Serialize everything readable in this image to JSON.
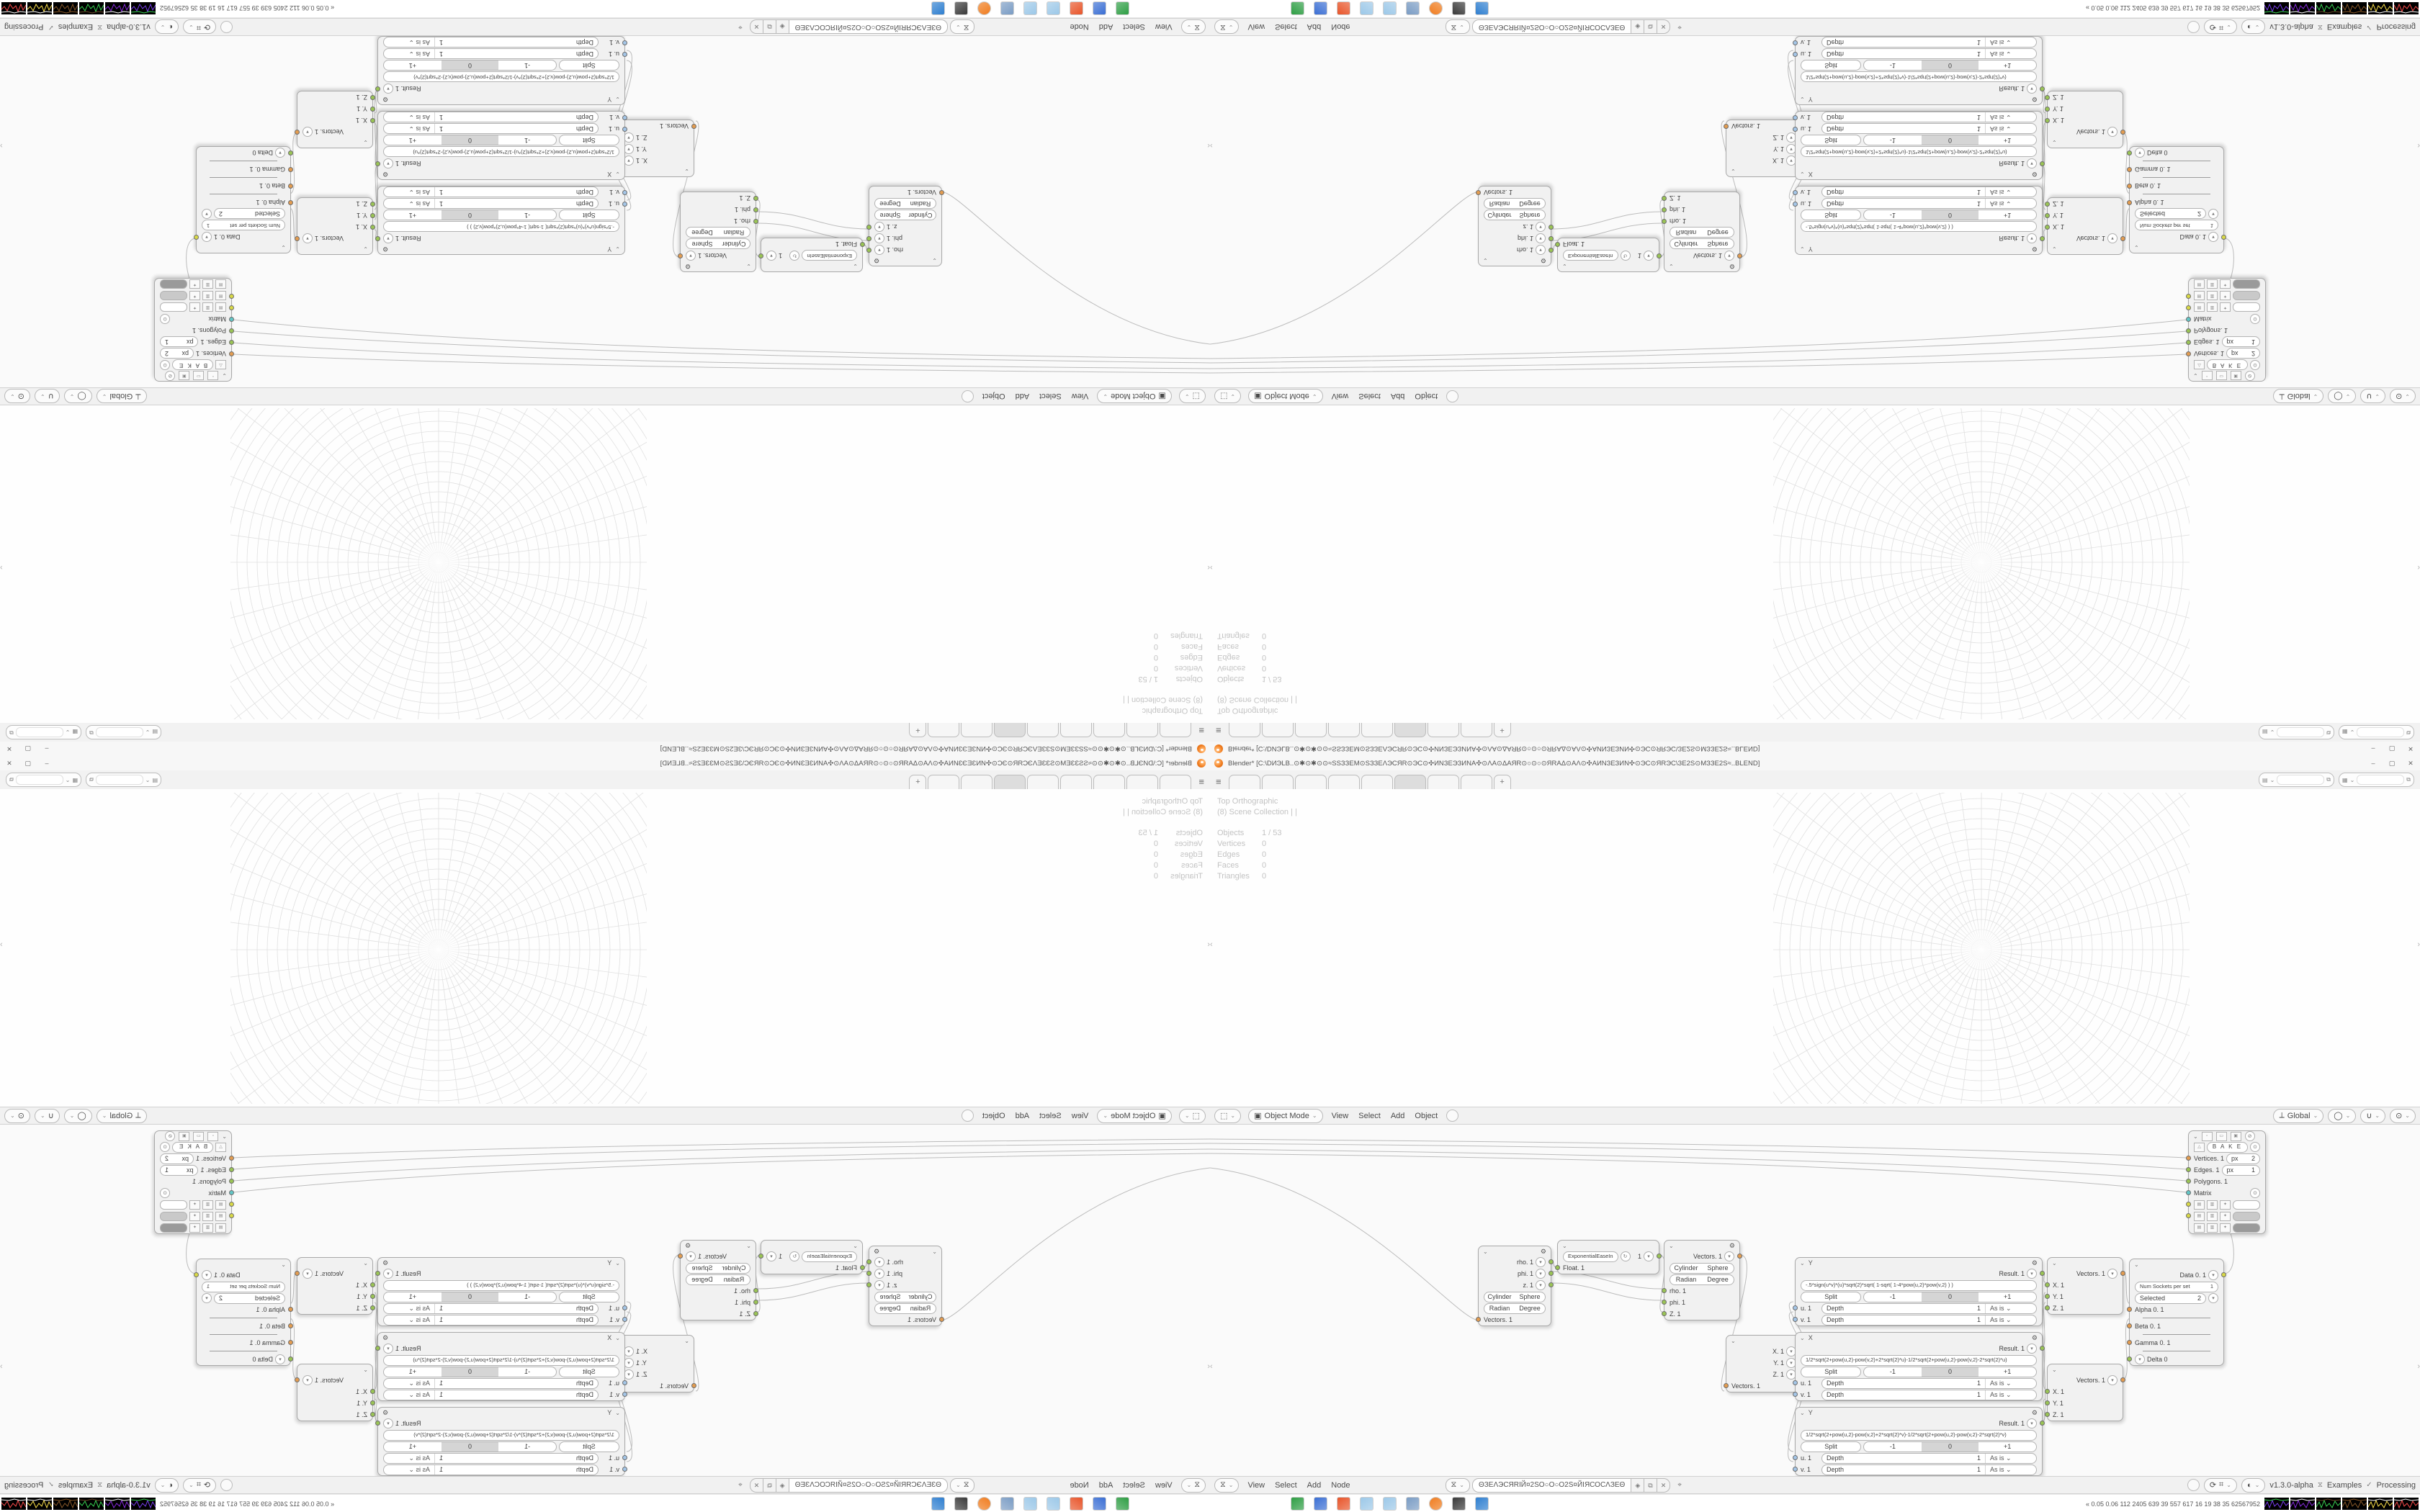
{
  "titlebar": {
    "title": "Blender* [C:\\DИЭLB..⊙✱⊙✱⊙⊙≈SSЗЗEM⊙SЗЗEΛЭCЯR⊙ЭC⊙✣ИNЗЕЭЗИNA✣⊙ΛA⊙ΔAЯR⊙○⊙○⊙ЯRAΔ⊙AΛ⊙✣AИNЗЕЗИN✣⊙ЭC⊙ЯRЭC\\ЗЕ2S⊙MЗЗЕ2S≈..BLEND]",
    "minimize": "–",
    "maximize": "▢",
    "close": "✕"
  },
  "topbar": {
    "menu_icon": "≡",
    "tabs": [
      "",
      "",
      "",
      "",
      "",
      "",
      "",
      ""
    ],
    "active_tab_index": 5,
    "new_tab": "+"
  },
  "viewport": {
    "overlay_view": "Top Orthographic",
    "overlay_collection": "(8) Scene Collection | |",
    "stats": [
      {
        "label": "Objects",
        "value": "1 / 53"
      },
      {
        "label": "Vertices",
        "value": "0"
      },
      {
        "label": "Edges",
        "value": "0"
      },
      {
        "label": "Faces",
        "value": "0"
      },
      {
        "label": "Triangles",
        "value": "0"
      }
    ]
  },
  "viewport_header": {
    "editor_icon": "⬚",
    "mode": "Object Mode",
    "menus": [
      "View",
      "Select",
      "Add",
      "Object"
    ],
    "orientation": "Global"
  },
  "node_header": {
    "editor_icon": "⧖",
    "menus": [
      "View",
      "Select",
      "Add",
      "Node"
    ],
    "tree_name": "ΘЗЕΛЭСЯRIЙ¤2SО○О○О2S¤ЙIЯСОСΛЗЕΘ",
    "shield_icon": "◈",
    "copy_icon": "⧉",
    "close_icon": "✕",
    "pin_icon": "⌖",
    "version": "v1.3.0-alpha",
    "sverchok_icon": "⧖",
    "examples_label": "Examples",
    "check_icon": "✓",
    "processing_label": "Processing"
  },
  "node_editor": {
    "viewer_draw": {
      "bake_label": "B A K E",
      "px_label": "px",
      "inputs": [
        {
          "label": "Vertices. 1",
          "px": "2"
        },
        {
          "label": "Edges. 1",
          "px": "1"
        },
        {
          "label": "Polygons. 1",
          "px": ""
        },
        {
          "label": "Matrix",
          "px": ""
        }
      ],
      "swatches": [
        "#ffffff",
        "#c9c9c9",
        "#9a9a9a"
      ]
    },
    "polar_out": {
      "outputs": [
        "rho. 1",
        "phi. 1",
        "z. 1"
      ],
      "toggle1": [
        "Cylinder",
        "Sphere"
      ],
      "toggle2": [
        "Radian",
        "Degree"
      ],
      "input": "Vectors. 1"
    },
    "easing": {
      "mode": "ExponentialEaseIn",
      "value": "1",
      "input": "Float. 1"
    },
    "polar_in": {
      "output": "Vectors. 1",
      "toggle1": [
        "Cylinder",
        "Sphere"
      ],
      "toggle2": [
        "Radian",
        "Degree"
      ],
      "inputs": [
        "rho. 1",
        "phi. 1",
        "Z. 1"
      ]
    },
    "vector_out": {
      "outputs": [
        "X. 1",
        "Y. 1",
        "Z. 1"
      ],
      "input": "Vectors. 1"
    },
    "formulas": [
      {
        "title": "Y",
        "formula": "-.5*sign(u*v)*(u)*sqrt(2)*sqrt( 1-sqrt( 1-4*pow(u,2)*pow(v,2) ) )",
        "result": "Result. 1",
        "split": "Split",
        "wrap": [
          "-1",
          "0",
          "+1"
        ],
        "u": "u. 1",
        "v": "v. 1",
        "depth": "Depth",
        "depth_val": "1",
        "as_is": "As is"
      },
      {
        "title": "X",
        "formula": "1/2*sqrt(2+pow(u,2)-pow(v,2)+2*sqrt(2)*u)-1/2*sqrt(2+pow(u,2)-pow(v,2)-2*sqrt(2)*u)",
        "result": "Result. 1",
        "split": "Split",
        "wrap": [
          "-1",
          "0",
          "+1"
        ],
        "u": "u. 1",
        "v": "v. 1",
        "depth": "Depth",
        "depth_val": "1",
        "as_is": "As is"
      },
      {
        "title": "Y",
        "formula": "1/2*sqrt(2+pow(u,2)-pow(v,2)+2*sqrt(2)*v)-1/2*sqrt(2+pow(u,2)-pow(v,2)-2*sqrt(2)*v)",
        "result": "Result. 1",
        "split": "Split",
        "wrap": [
          "-1",
          "0",
          "+1"
        ],
        "u": "u. 1",
        "v": "v. 1",
        "depth": "Depth",
        "depth_val": "1",
        "as_is": "As is"
      }
    ],
    "vector_in": {
      "output": "Vectors. 1",
      "inputs": [
        "X. 1",
        "Y. 1",
        "Z. 1"
      ]
    },
    "input_switch": {
      "output": "Data 0. 1",
      "num_sockets_label": "Num Sockets per set",
      "num_sockets": "1",
      "selected_label": "Selected",
      "selected": "2",
      "inputs": [
        "Alpha 0. 1",
        "Beta 0. 1",
        "Gamma 0. 1",
        "Delta 0"
      ]
    }
  },
  "taskbar": {
    "icons": [
      {
        "name": "file-manager",
        "color": "#2e9e44"
      },
      {
        "name": "floppy-save",
        "color": "#3b6fd4"
      },
      {
        "name": "browser-orange",
        "color": "#e8552a"
      },
      {
        "name": "notebook-1",
        "color": "#9cc8e8"
      },
      {
        "name": "notebook-2",
        "color": "#9cc8e8"
      },
      {
        "name": "image-viewer",
        "color": "#7a9cc4"
      },
      {
        "name": "blender",
        "color": "#f07c1e"
      },
      {
        "name": "audio-app",
        "color": "#3a3a3a"
      },
      {
        "name": "display-app",
        "color": "#2f7fd0"
      }
    ],
    "perf_text": "« 0.05 0.06 112 2405 639 39 557 617 16 19 38 35 62567952",
    "graph_colors": [
      [
        "#7a3df0",
        "#39d353"
      ],
      [
        "#8a2be2",
        "#ffffff"
      ],
      [
        "#39d353",
        "#6b4a2a"
      ],
      [
        "#8a5a2a",
        "#8a5a2a"
      ],
      [
        "#ffe34d",
        "#ffffff"
      ],
      [
        "#ff4d4d",
        "#ffffff"
      ]
    ]
  }
}
